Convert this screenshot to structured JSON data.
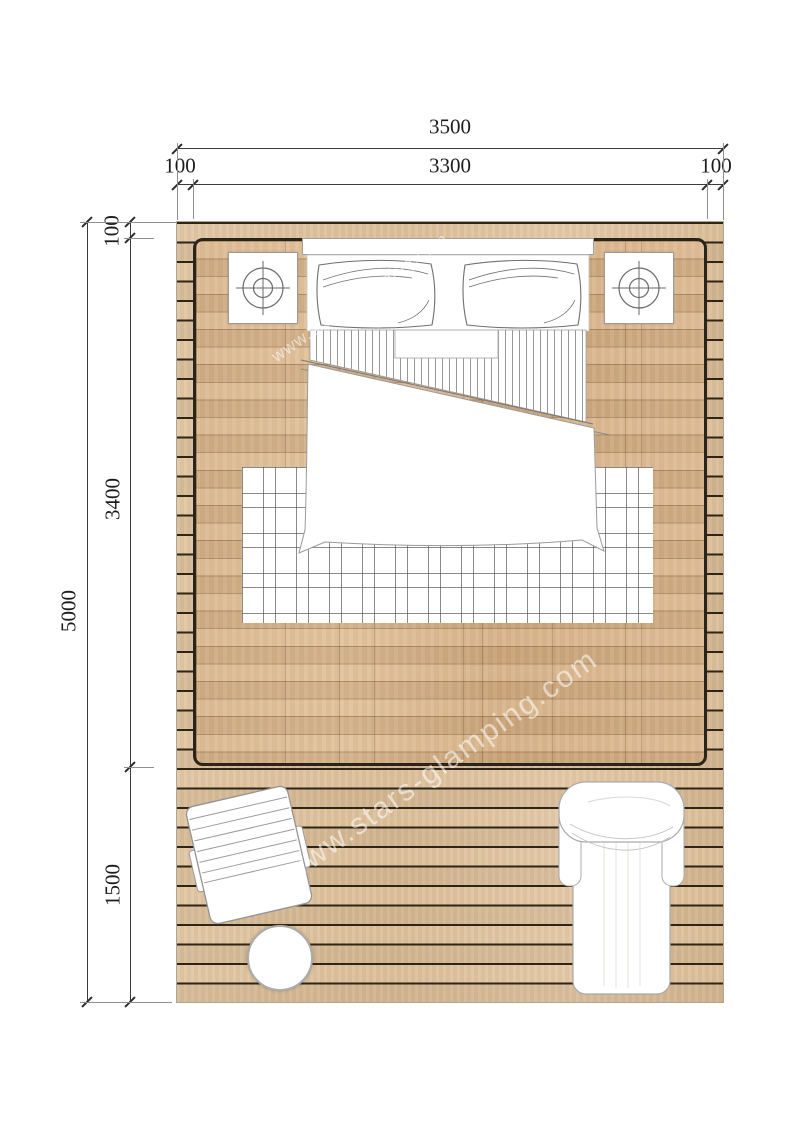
{
  "drawing": {
    "type": "floor-plan",
    "watermark_text": "www.stars-glamping.com",
    "dimensions": {
      "top": {
        "total": "3500",
        "segments": [
          "100",
          "3300",
          "100"
        ]
      },
      "left": {
        "total": "5000",
        "segments": [
          "100",
          "3400",
          "1500"
        ]
      }
    },
    "contents": [
      "double-bed",
      "pillows",
      "nightstand-with-lamp-left",
      "nightstand-with-lamp-right",
      "plaid-rug",
      "interior-parquet-floor",
      "outdoor-deck",
      "deck-lounge-chair",
      "round-side-table",
      "outdoor-lounger"
    ],
    "colors": {
      "background": "#ffffff",
      "deck_wood": "#dcc09b",
      "deck_gap": "#2e2517",
      "floor_wood": "#d8b389",
      "room_border": "#2b241a",
      "dimension_line": "#3c3c3c",
      "furniture_outline": "#9b9b9b",
      "watermark": "#ffffff"
    }
  }
}
